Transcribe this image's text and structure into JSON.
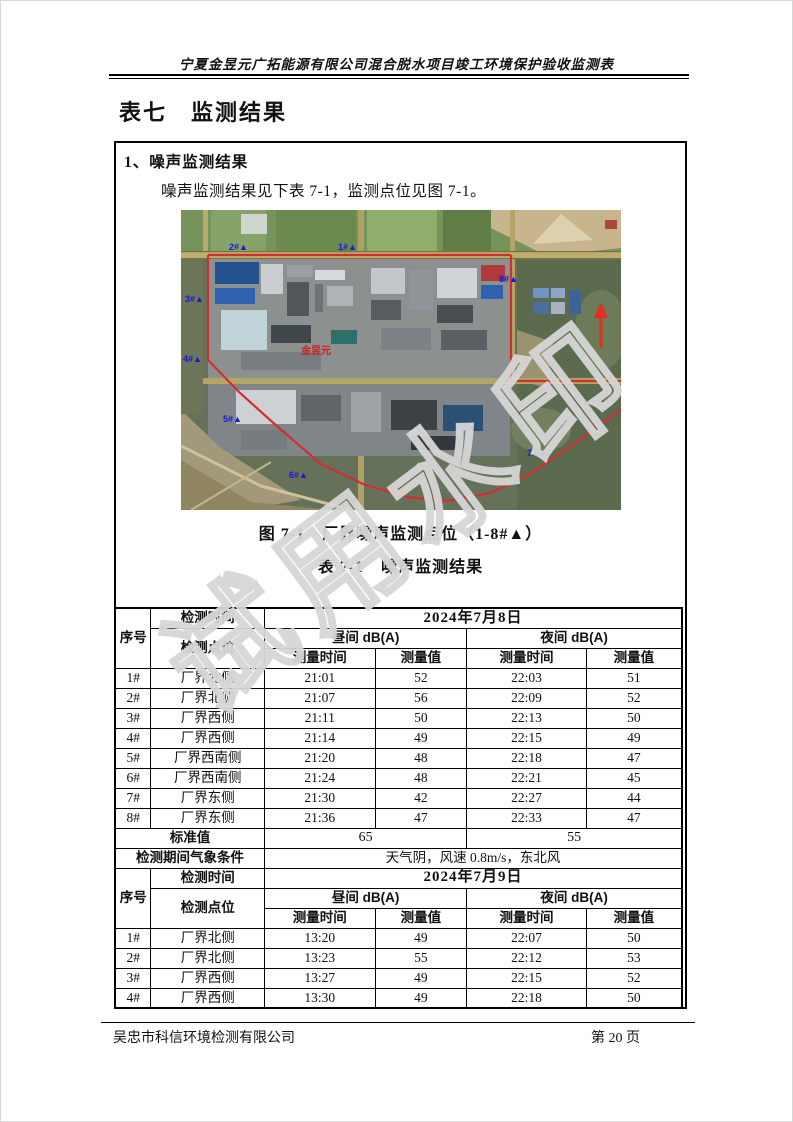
{
  "page": {
    "header_title": "宁夏金昱元广拓能源有限公司混合脱水项目竣工环境保护验收监测表",
    "section_title": "表七　监测结果",
    "footer": {
      "company": "吴忠市科信环境检测有限公司",
      "page_label": "第 20 页"
    }
  },
  "content": {
    "heading": "1、噪声监测结果",
    "intro": "噪声监测结果见下表 7-1，监测点位见图 7-1。",
    "figure_caption": "图 7-1　厂界噪声监测点位（1-8#▲）",
    "table_caption": "表 7-1　噪声监测结果"
  },
  "map": {
    "company_label": "金昱元",
    "boundary_color": "#d12f2f",
    "marker_color": "#1717d6",
    "markers": [
      {
        "label": "2#▲"
      },
      {
        "label": "1#▲"
      },
      {
        "label": "8#▲"
      },
      {
        "label": "3#▲"
      },
      {
        "label": "4#▲"
      },
      {
        "label": "5#▲"
      },
      {
        "label": "6#▲"
      },
      {
        "label": "7#▲"
      }
    ]
  },
  "noise_table": {
    "headers": {
      "seq": "序号",
      "time_label": "检测时间",
      "point_label": "检测点位",
      "day_label": "昼间 dB(A)",
      "night_label": "夜间 dB(A)",
      "measure_time": "测量时间",
      "measure_value": "测量值"
    },
    "day1": {
      "date": "2024年7月8日",
      "rows": [
        [
          "1#",
          "厂界北侧",
          "21:01",
          "52",
          "22:03",
          "51"
        ],
        [
          "2#",
          "厂界北侧",
          "21:07",
          "56",
          "22:09",
          "52"
        ],
        [
          "3#",
          "厂界西侧",
          "21:11",
          "50",
          "22:13",
          "50"
        ],
        [
          "4#",
          "厂界西侧",
          "21:14",
          "49",
          "22:15",
          "49"
        ],
        [
          "5#",
          "厂界西南侧",
          "21:20",
          "48",
          "22:18",
          "47"
        ],
        [
          "6#",
          "厂界西南侧",
          "21:24",
          "48",
          "22:21",
          "45"
        ],
        [
          "7#",
          "厂界东侧",
          "21:30",
          "42",
          "22:27",
          "44"
        ],
        [
          "8#",
          "厂界东侧",
          "21:36",
          "47",
          "22:33",
          "47"
        ]
      ]
    },
    "standard": {
      "label": "标准值",
      "day": "65",
      "night": "55"
    },
    "weather": {
      "label": "检测期间气象条件",
      "value": "天气阴，风速 0.8m/s，东北风"
    },
    "day2": {
      "date": "2024年7月9日",
      "rows": [
        [
          "1#",
          "厂界北侧",
          "13:20",
          "49",
          "22:07",
          "50"
        ],
        [
          "2#",
          "厂界北侧",
          "13:23",
          "55",
          "22:12",
          "53"
        ],
        [
          "3#",
          "厂界西侧",
          "13:27",
          "49",
          "22:15",
          "52"
        ],
        [
          "4#",
          "厂界西侧",
          "13:30",
          "49",
          "22:18",
          "50"
        ]
      ]
    }
  },
  "watermark": "试用水印"
}
